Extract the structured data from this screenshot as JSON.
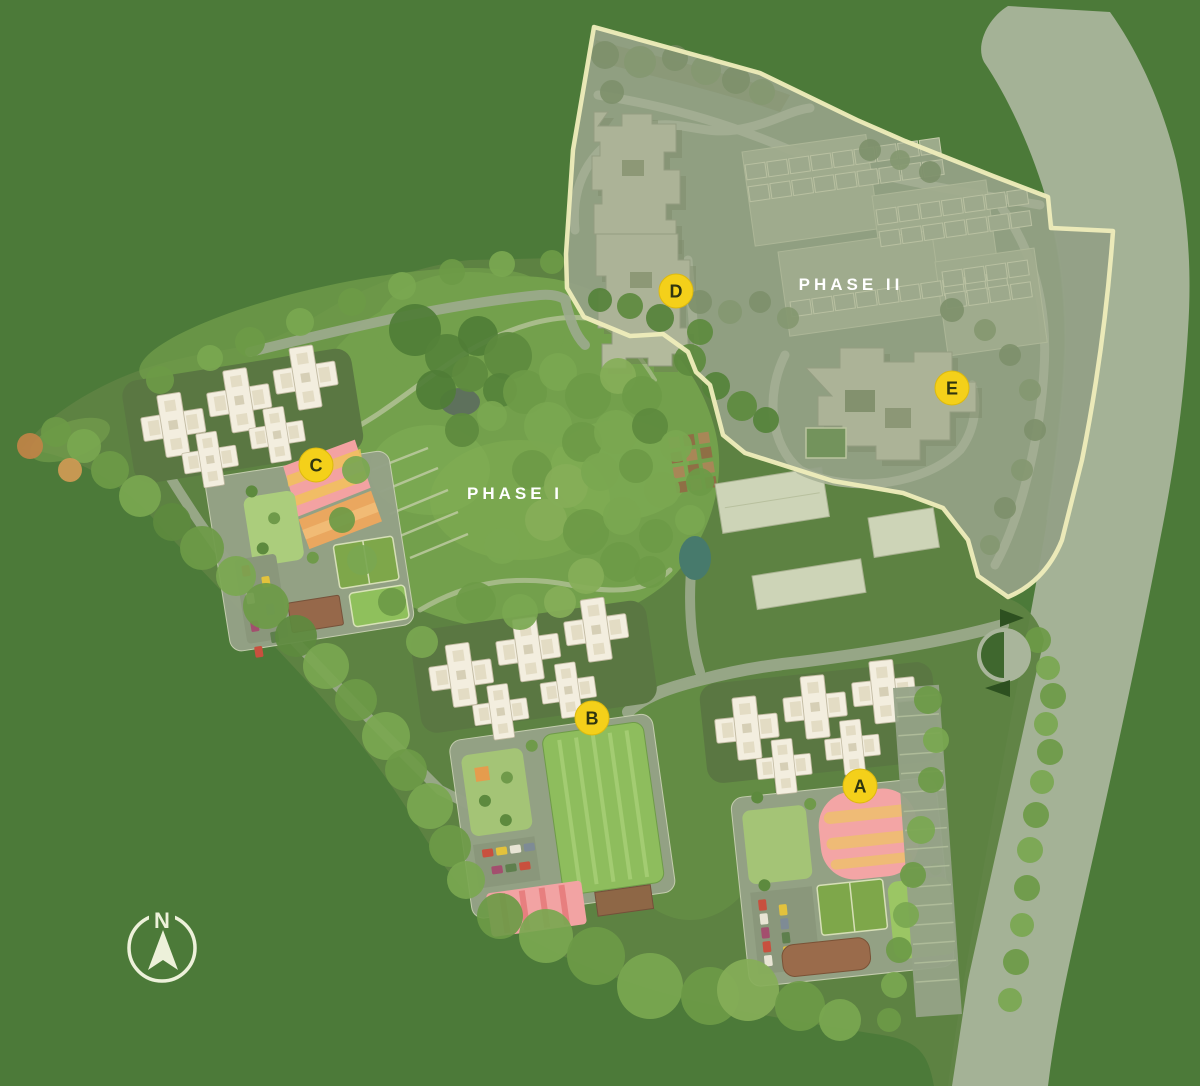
{
  "site_plan": {
    "background_color": "#4c7a39",
    "boundary_color": "#efedbb",
    "label_color": "#ffffff",
    "phase1": {
      "label": "PHASE I"
    },
    "phase2": {
      "label": "PHASE II"
    },
    "compass": {
      "label": "N"
    },
    "building_markers": [
      {
        "label": "A",
        "x": 860,
        "y": 786
      },
      {
        "label": "B",
        "x": 592,
        "y": 718
      },
      {
        "label": "C",
        "x": 316,
        "y": 465
      },
      {
        "label": "D",
        "x": 676,
        "y": 291
      },
      {
        "label": "E",
        "x": 952,
        "y": 388
      }
    ],
    "marker_style": {
      "fill": "#f4d01a",
      "stroke": "#dcb90e",
      "text_color": "#2f3510"
    }
  }
}
